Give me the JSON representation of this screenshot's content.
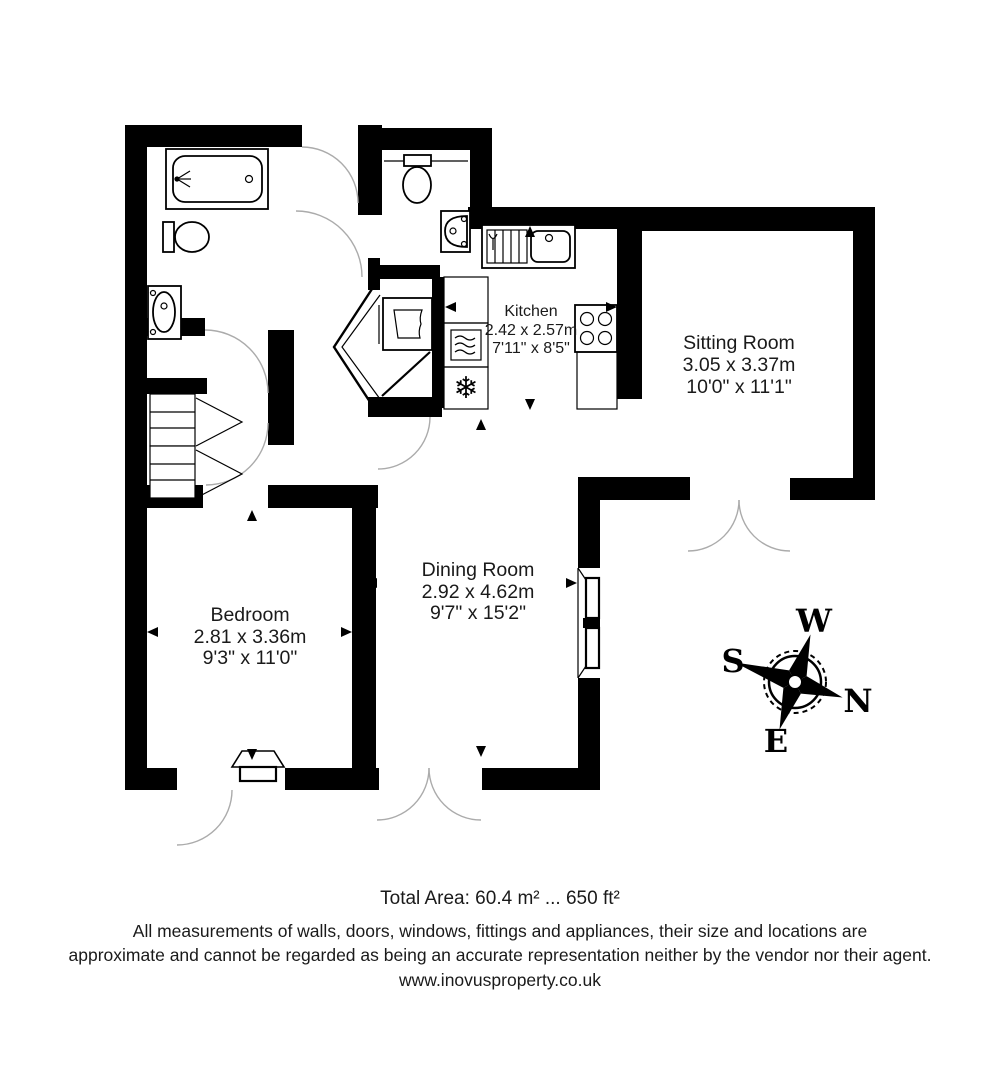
{
  "plan": {
    "rooms": [
      {
        "id": "kitchen",
        "name": "Kitchen",
        "metric": "2.42 x 2.57m",
        "imperial": "7'11\" x 8'5\""
      },
      {
        "id": "sitting_room",
        "name": "Sitting Room",
        "metric": "3.05 x 3.37m",
        "imperial": "10'0\" x 11'1\""
      },
      {
        "id": "dining_room",
        "name": "Dining Room",
        "metric": "2.92 x 4.62m",
        "imperial": "9'7\" x 15'2\""
      },
      {
        "id": "bedroom",
        "name": "Bedroom",
        "metric": "2.81 x 3.36m",
        "imperial": "9'3\" x 11'0\""
      }
    ],
    "compass": {
      "n": "N",
      "s": "S",
      "e": "E",
      "w": "W"
    },
    "colors": {
      "wall": "#000000",
      "door_arc": "#ababab",
      "background": "#ffffff"
    },
    "icons": [
      "bathtub-icon",
      "toilet-icon",
      "basin-icon",
      "kitchen-sink-icon",
      "hob-icon",
      "microwave-icon",
      "freezer-icon",
      "boiler-icon",
      "snowflake-icon",
      "compass-rose"
    ]
  },
  "footer": {
    "total_area": "Total Area: 60.4 m² ... 650 ft²",
    "disclaimer_line1": "All measurements of walls, doors, windows, fittings and appliances, their size and locations are",
    "disclaimer_line2": "approximate and cannot be regarded as being an accurate representation neither by the vendor nor their agent.",
    "website": "www.inovusproperty.co.uk"
  }
}
